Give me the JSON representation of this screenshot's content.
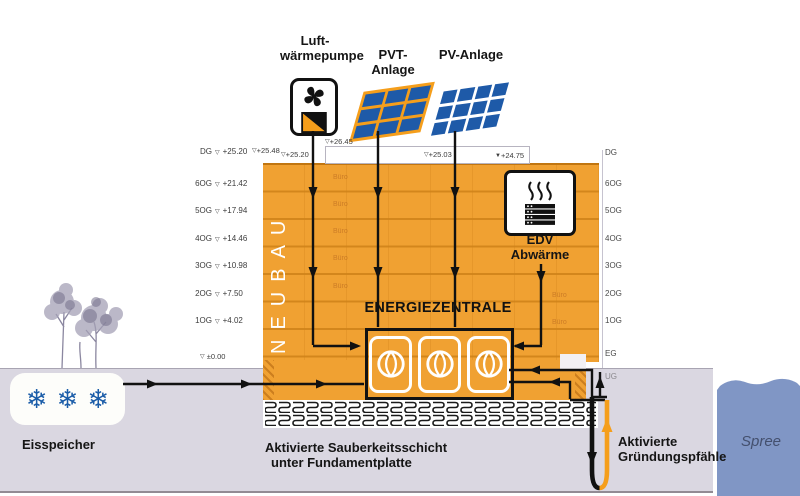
{
  "icons_row": {
    "heat_pump_label_line1": "Luft-",
    "heat_pump_label_line2": "wärmepumpe",
    "pvt_label": "PVT-Anlage",
    "pv_label": "PV-Anlage"
  },
  "building": {
    "name_vertical": "NEUBAU",
    "room_label": "Büro",
    "energy_center_label": "ENERGIEZENTRALE"
  },
  "edv": {
    "line1": "EDV",
    "line2": "Abwärme"
  },
  "elevations": {
    "left_floors": [
      {
        "floor": "DG",
        "value": "+25.20"
      },
      {
        "floor": "6OG",
        "value": "+21.42"
      },
      {
        "floor": "5OG",
        "value": "+17.94"
      },
      {
        "floor": "4OG",
        "value": "+14.46"
      },
      {
        "floor": "3OG",
        "value": "+10.98"
      },
      {
        "floor": "2OG",
        "value": "+7.50"
      },
      {
        "floor": "1OG",
        "value": "+4.02"
      }
    ],
    "ground_zero": "±0.00",
    "roof_marks": [
      {
        "value": "+25.48"
      },
      {
        "value": "+25.20"
      },
      {
        "value": "+26.45"
      },
      {
        "value": "+25.03"
      },
      {
        "value": "+24.75"
      }
    ],
    "right_floors": [
      "DG",
      "6OG",
      "5OG",
      "4OG",
      "3OG",
      "2OG",
      "1OG",
      "EG",
      "UG"
    ]
  },
  "ground": {
    "ice_storage_label": "Eisspeicher",
    "clean_layer_line1": "Aktivierte Sauberkeitsschicht",
    "clean_layer_line2": "unter Fundamentplatte",
    "piles_line1": "Aktivierte",
    "piles_line2": "Gründungspfähle",
    "river_label": "Spree"
  },
  "glyphs": {
    "level_marker": "▽",
    "level_marker_filled": "▼",
    "snowflake": "❄"
  },
  "colors": {
    "orange": "#F0A132",
    "accent": "#F59E1B",
    "panel": "#1E5AA8",
    "snow": "#1A5CA8",
    "river": "#8096C5",
    "ground": "#DAD7E1"
  }
}
